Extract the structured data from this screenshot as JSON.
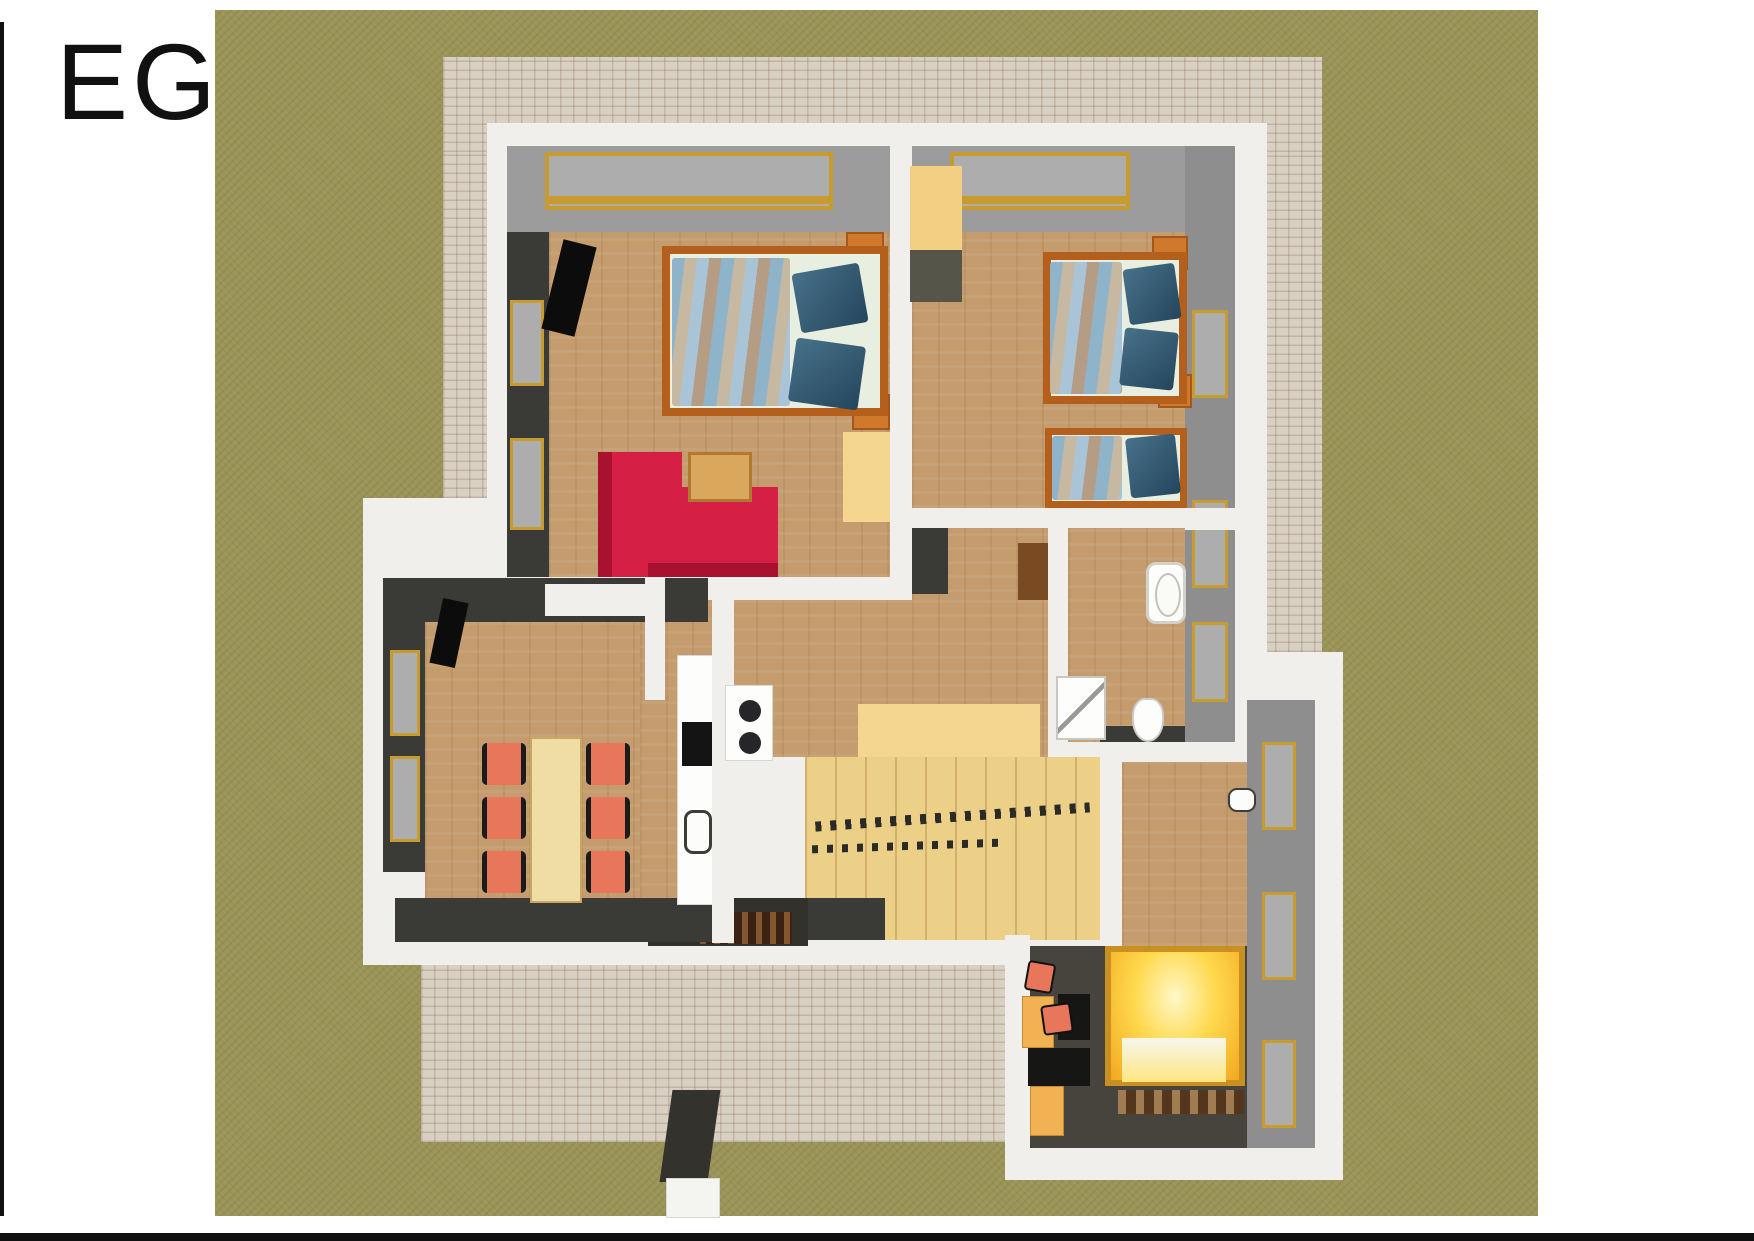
{
  "page": {
    "title": "EG"
  },
  "colors": {
    "ink": "#111111",
    "grass": "#9a9457",
    "patio": "#d8d0c3",
    "wall": "#f1efeb",
    "wood": "#c49c6e",
    "dark_wall": "#3a3a37",
    "gray_face": "#8e8e8e",
    "gray_top": "#9c9c9c",
    "gold": "#c89b2e",
    "glass": "#adadad",
    "bed_frame": "#b45f1b",
    "bed_post": "#d0782c",
    "mattress": "#e9efe0",
    "pillow_a": "#47718a",
    "pillow_b": "#24465c",
    "blanket_a": "#8fb3c9",
    "blanket_b": "#c7b8a2",
    "blanket_c": "#a8c4d6",
    "blanket_d": "#b59d85",
    "sofa": "#d61f44",
    "sofa_dark": "#a81230",
    "coffee_table": "#d9a85c",
    "dining_table": "#f0dda6",
    "chair": "#e8765a",
    "bench": "#f5d68e",
    "bench_shadow": "#77755e",
    "stairs": "#ecd088",
    "railing": "#2a2a26",
    "glow_hi": "#fff8c8",
    "glow_mid": "#ffd94e",
    "glow_lo": "#f3a81f",
    "glow_frame": "#c89020",
    "rug": "#54361c",
    "dark_floor": "#46443d",
    "entry_dark": "#33312c",
    "doormat": "#3a2212",
    "walkway": "#34322d",
    "black": "#141414",
    "counter": "#fdfdfb",
    "cabinet": "#f2b254",
    "wardrobe": "#f2cf82",
    "wardrobe_front": "#56554a",
    "brown_cab": "#7a4a22"
  },
  "scene": {
    "type": "3d-floorplan-render",
    "floor": "EG",
    "rooms": [
      "bedroom-living-top-left",
      "bedroom-top-right",
      "hallway-center",
      "bathroom-right",
      "dining-room-left",
      "kitchen",
      "stair-hall",
      "entry",
      "corridor-lower-right",
      "bedroom-lower-right"
    ],
    "exterior": [
      "lawn",
      "paved-patio",
      "entrance-walkway"
    ]
  }
}
